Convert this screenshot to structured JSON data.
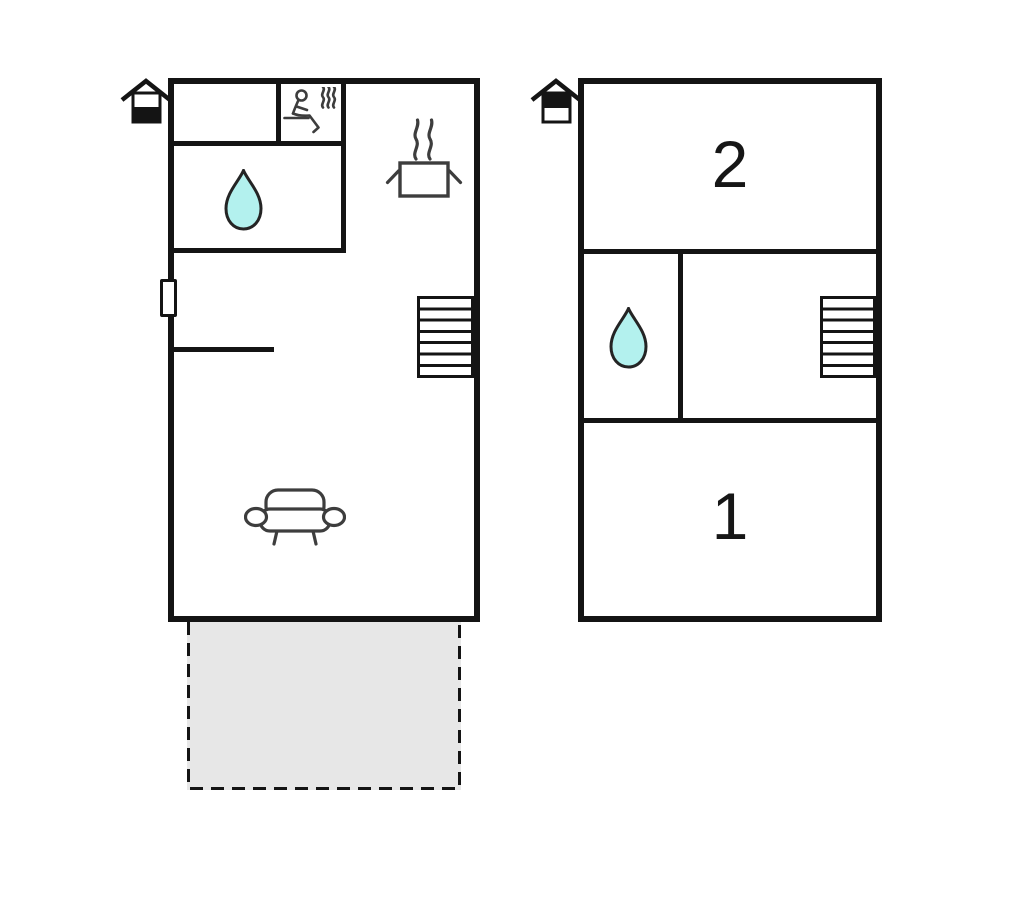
{
  "canvas": {
    "width": 1024,
    "height": 905,
    "background": "#ffffff"
  },
  "colors": {
    "wall": "#141414",
    "icon_stroke": "#3d3d3d",
    "water_drop_fill": "#b3f1ee",
    "water_drop_stroke": "#242424",
    "terrace_fill": "#e7e7e7",
    "label_color": "#161616"
  },
  "floorplans": [
    {
      "name": "ground-floor",
      "position": "left",
      "floor_indicator": {
        "icon": "house-floor-icon",
        "filled_section": "bottom"
      },
      "rooms": [
        {
          "name": "entry-room",
          "label": ""
        },
        {
          "name": "sauna",
          "label": "",
          "icon": "sauna-icon"
        },
        {
          "name": "bathroom",
          "label": "",
          "icon": "water-drop-icon"
        },
        {
          "name": "living-kitchen-area",
          "label": "",
          "icons": [
            "cooking-pot-icon",
            "stairs-icon",
            "sofa-icon"
          ]
        }
      ],
      "features": [
        {
          "name": "window-marker"
        },
        {
          "name": "terrace",
          "style": "dashed-outline",
          "fill": "#e7e7e7"
        }
      ]
    },
    {
      "name": "upper-floor",
      "position": "right",
      "floor_indicator": {
        "icon": "house-floor-icon",
        "filled_section": "top"
      },
      "rooms": [
        {
          "name": "bedroom-2",
          "label": "2"
        },
        {
          "name": "bathroom",
          "label": "",
          "icon": "water-drop-icon"
        },
        {
          "name": "hall",
          "label": "",
          "icon": "stairs-icon"
        },
        {
          "name": "bedroom-1",
          "label": "1"
        }
      ]
    }
  ]
}
